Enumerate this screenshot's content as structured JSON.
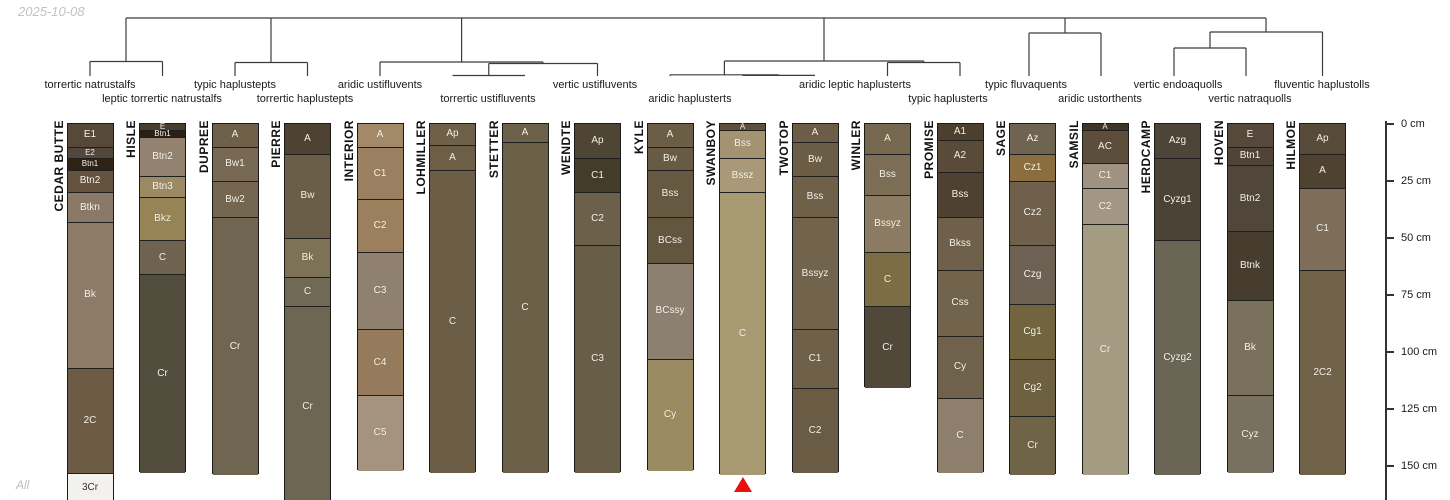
{
  "meta": {
    "timestamp": "2025-10-08",
    "corner_label": "All"
  },
  "chart_data": {
    "type": "soil-profile-dendrogram",
    "title": "",
    "depth_axis": {
      "unit": "cm",
      "ticks": [
        {
          "cm": 0,
          "label": "0 cm"
        },
        {
          "cm": 25,
          "label": "25 cm"
        },
        {
          "cm": 50,
          "label": "50 cm"
        },
        {
          "cm": 75,
          "label": "75 cm"
        },
        {
          "cm": 100,
          "label": "100 cm"
        },
        {
          "cm": 125,
          "label": "125 cm"
        },
        {
          "cm": 150,
          "label": "150 cm"
        }
      ]
    },
    "line_color": "#3c3c3c",
    "dendrogram_segments": [
      [
        126,
        18,
        1266,
        18
      ],
      [
        126,
        18,
        126,
        61.5
      ],
      [
        90,
        61.5,
        162.5,
        61.5
      ],
      [
        90,
        61.5,
        90,
        76
      ],
      [
        162.5,
        61.5,
        162.5,
        76
      ],
      [
        271,
        18,
        271,
        62.5
      ],
      [
        235,
        62.5,
        307.5,
        62.5
      ],
      [
        235,
        62.5,
        235,
        76
      ],
      [
        307.5,
        62.5,
        307.5,
        76
      ],
      [
        461.6,
        18,
        461.6,
        62
      ],
      [
        380,
        62,
        543,
        62
      ],
      [
        380,
        62,
        380,
        76
      ],
      [
        543,
        62,
        543,
        63.5
      ],
      [
        488.75,
        63.5,
        597.5,
        63.5
      ],
      [
        597.5,
        63.5,
        597.5,
        76
      ],
      [
        488.75,
        63.5,
        488.75,
        75.5
      ],
      [
        452.5,
        75.5,
        525,
        75.5
      ],
      [
        824,
        18,
        824,
        61
      ],
      [
        724.4,
        61,
        923.75,
        61
      ],
      [
        724.4,
        61,
        724.4,
        74.8
      ],
      [
        670,
        74.8,
        778.75,
        74.8
      ],
      [
        670,
        74.8,
        670,
        76
      ],
      [
        778.75,
        74.8,
        778.75,
        75.4
      ],
      [
        742.5,
        75.4,
        815,
        75.4
      ],
      [
        923.75,
        61,
        923.75,
        62.5
      ],
      [
        887.5,
        62.5,
        960,
        62.5
      ],
      [
        887.5,
        62.5,
        887.5,
        76
      ],
      [
        960,
        62.5,
        960,
        76
      ],
      [
        1065,
        18,
        1065,
        33
      ],
      [
        1029,
        33,
        1101,
        33
      ],
      [
        1029,
        33,
        1029,
        76
      ],
      [
        1101,
        33,
        1101,
        76
      ],
      [
        1266,
        18,
        1266,
        32
      ],
      [
        1210,
        32,
        1322.5,
        32
      ],
      [
        1322.5,
        32,
        1322.5,
        76
      ],
      [
        1210,
        32,
        1210,
        48
      ],
      [
        1174,
        48,
        1246,
        48
      ],
      [
        1174,
        48,
        1174,
        76
      ],
      [
        1246,
        48,
        1246,
        76
      ]
    ],
    "taxa_labels": [
      {
        "text": "torrertic natrustalfs",
        "x": 90,
        "row": 1
      },
      {
        "text": "leptic torrertic natrustalfs",
        "x": 162,
        "row": 2
      },
      {
        "text": "typic haplustepts",
        "x": 235,
        "row": 1
      },
      {
        "text": "torrertic haplustepts",
        "x": 305,
        "row": 2
      },
      {
        "text": "aridic ustifluvents",
        "x": 380,
        "row": 1
      },
      {
        "text": "torrertic ustifluvents",
        "x": 488,
        "row": 2
      },
      {
        "text": "vertic ustifluvents",
        "x": 595,
        "row": 1
      },
      {
        "text": "aridic haplusterts",
        "x": 690,
        "row": 2
      },
      {
        "text": "aridic leptic haplusterts",
        "x": 855,
        "row": 1
      },
      {
        "text": "typic haplusterts",
        "x": 948,
        "row": 2
      },
      {
        "text": "typic fluvaquents",
        "x": 1026,
        "row": 1
      },
      {
        "text": "aridic ustorthents",
        "x": 1100,
        "row": 2
      },
      {
        "text": "vertic endoaquolls",
        "x": 1178,
        "row": 1
      },
      {
        "text": "vertic natraquolls",
        "x": 1250,
        "row": 2
      },
      {
        "text": "fluventic haplustolls",
        "x": 1322,
        "row": 1
      }
    ],
    "profiles": [
      {
        "name": "CEDAR BUTTE",
        "x": 90,
        "horizons": [
          {
            "label": "E1",
            "top": 0,
            "bottom": 10,
            "color": "#57493a"
          },
          {
            "label": "E2",
            "top": 10,
            "bottom": 15,
            "color": "#53463a"
          },
          {
            "label": "Btn1",
            "top": 15,
            "bottom": 20,
            "color": "#2f2316"
          },
          {
            "label": "Btn2",
            "top": 20,
            "bottom": 30,
            "color": "#65523f"
          },
          {
            "label": "Btkn",
            "top": 30,
            "bottom": 43,
            "color": "#8b7968"
          },
          {
            "label": "Bk",
            "top": 43,
            "bottom": 107,
            "color": "#8d7b67"
          },
          {
            "label": "2C",
            "top": 107,
            "bottom": 153,
            "color": "#6e5b46"
          },
          {
            "label": "3Cr",
            "top": 153,
            "bottom": 166,
            "color": "#f2f1ee",
            "text": "#333333"
          }
        ]
      },
      {
        "name": "HISLE",
        "x": 162.5,
        "horizons": [
          {
            "label": "E",
            "top": 0,
            "bottom": 2.5,
            "color": "#4a3e2f"
          },
          {
            "label": "Btn1",
            "top": 2.5,
            "bottom": 5.5,
            "color": "#2b2015"
          },
          {
            "label": "Btn2",
            "top": 5.5,
            "bottom": 23,
            "color": "#93826f"
          },
          {
            "label": "Btn3",
            "top": 23,
            "bottom": 32,
            "color": "#9b8a64"
          },
          {
            "label": "Bkz",
            "top": 32,
            "bottom": 51,
            "color": "#968356"
          },
          {
            "label": "C",
            "top": 51,
            "bottom": 66,
            "color": "#6f6350"
          },
          {
            "label": "Cr",
            "top": 66,
            "bottom": 153,
            "color": "#524d3d"
          }
        ]
      },
      {
        "name": "DUPREE",
        "x": 235,
        "horizons": [
          {
            "label": "A",
            "top": 0,
            "bottom": 10,
            "color": "#6f6149"
          },
          {
            "label": "Bw1",
            "top": 10,
            "bottom": 25,
            "color": "#776954"
          },
          {
            "label": "Bw2",
            "top": 25,
            "bottom": 41,
            "color": "#74664f"
          },
          {
            "label": "Cr",
            "top": 41,
            "bottom": 154,
            "color": "#6f6551"
          }
        ]
      },
      {
        "name": "PIERRE",
        "x": 307.5,
        "horizons": [
          {
            "label": "A",
            "top": 0,
            "bottom": 13,
            "color": "#4e4333"
          },
          {
            "label": "Bw",
            "top": 13,
            "bottom": 50,
            "color": "#6b5e49"
          },
          {
            "label": "Bk",
            "top": 50,
            "bottom": 67,
            "color": "#7d7156"
          },
          {
            "label": "C",
            "top": 67,
            "bottom": 80,
            "color": "#706955"
          },
          {
            "label": "Cr",
            "top": 80,
            "bottom": 168,
            "color": "#6c6652"
          }
        ]
      },
      {
        "name": "INTERIOR",
        "x": 380,
        "horizons": [
          {
            "label": "A",
            "top": 0,
            "bottom": 10,
            "color": "#a28a68"
          },
          {
            "label": "C1",
            "top": 10,
            "bottom": 33,
            "color": "#9a8061"
          },
          {
            "label": "C2",
            "top": 33,
            "bottom": 56,
            "color": "#9c7f5d"
          },
          {
            "label": "C3",
            "top": 56,
            "bottom": 90,
            "color": "#90806f"
          },
          {
            "label": "C4",
            "top": 90,
            "bottom": 119,
            "color": "#957a5b"
          },
          {
            "label": "C5",
            "top": 119,
            "bottom": 152,
            "color": "#a6937f"
          }
        ]
      },
      {
        "name": "LOHMILLER",
        "x": 452.5,
        "horizons": [
          {
            "label": "Ap",
            "top": 0,
            "bottom": 9,
            "color": "#6e6049"
          },
          {
            "label": "A",
            "top": 9,
            "bottom": 20,
            "color": "#6c5e47"
          },
          {
            "label": "C",
            "top": 20,
            "bottom": 153,
            "color": "#6b5d46"
          }
        ]
      },
      {
        "name": "STETTER",
        "x": 525,
        "horizons": [
          {
            "label": "A",
            "top": 0,
            "bottom": 8,
            "color": "#6e6149"
          },
          {
            "label": "C",
            "top": 8,
            "bottom": 153,
            "color": "#6c5f48"
          }
        ]
      },
      {
        "name": "WENDTE",
        "x": 597.5,
        "horizons": [
          {
            "label": "Ap",
            "top": 0,
            "bottom": 15,
            "color": "#4f4534"
          },
          {
            "label": "C1",
            "top": 15,
            "bottom": 30,
            "color": "#443c2a"
          },
          {
            "label": "C2",
            "top": 30,
            "bottom": 53,
            "color": "#6d604b"
          },
          {
            "label": "C3",
            "top": 53,
            "bottom": 153,
            "color": "#685d47"
          }
        ]
      },
      {
        "name": "KYLE",
        "x": 670,
        "horizons": [
          {
            "label": "A",
            "top": 0,
            "bottom": 10,
            "color": "#6b5d46"
          },
          {
            "label": "Bw",
            "top": 10,
            "bottom": 20,
            "color": "#685b44"
          },
          {
            "label": "Bss",
            "top": 20,
            "bottom": 41,
            "color": "#665841"
          },
          {
            "label": "BCss",
            "top": 41,
            "bottom": 61,
            "color": "#62563f"
          },
          {
            "label": "BCssy",
            "top": 61,
            "bottom": 103,
            "color": "#8c8171"
          },
          {
            "label": "Cy",
            "top": 103,
            "bottom": 152,
            "color": "#9b8b63"
          }
        ]
      },
      {
        "name": "SWANBOY",
        "x": 742.5,
        "horizons": [
          {
            "label": "A",
            "top": 0,
            "bottom": 2.5,
            "color": "#5f5139"
          },
          {
            "label": "Bss",
            "top": 2.5,
            "bottom": 15,
            "color": "#a39373"
          },
          {
            "label": "Bssz",
            "top": 15,
            "bottom": 30,
            "color": "#a99979"
          },
          {
            "label": "C",
            "top": 30,
            "bottom": 154,
            "color": "#a89a73"
          }
        ]
      },
      {
        "name": "TWOTOP",
        "x": 815,
        "horizons": [
          {
            "label": "A",
            "top": 0,
            "bottom": 8,
            "color": "#6b5d46"
          },
          {
            "label": "Bw",
            "top": 8,
            "bottom": 23,
            "color": "#6a5c45"
          },
          {
            "label": "Bss",
            "top": 23,
            "bottom": 41,
            "color": "#6e6049"
          },
          {
            "label": "Bssyz",
            "top": 41,
            "bottom": 90,
            "color": "#71634c"
          },
          {
            "label": "C1",
            "top": 90,
            "bottom": 116,
            "color": "#6e6049"
          },
          {
            "label": "C2",
            "top": 116,
            "bottom": 153,
            "color": "#695b44"
          }
        ]
      },
      {
        "name": "WINLER",
        "x": 887.5,
        "horizons": [
          {
            "label": "A",
            "top": 0,
            "bottom": 13,
            "color": "#76674f"
          },
          {
            "label": "Bss",
            "top": 13,
            "bottom": 31,
            "color": "#7c6d55"
          },
          {
            "label": "Bssyz",
            "top": 31,
            "bottom": 56,
            "color": "#8b7b62"
          },
          {
            "label": "C",
            "top": 56,
            "bottom": 80,
            "color": "#7e6c45"
          },
          {
            "label": "Cr",
            "top": 80,
            "bottom": 116,
            "color": "#50493a"
          }
        ]
      },
      {
        "name": "PROMISE",
        "x": 960,
        "horizons": [
          {
            "label": "A1",
            "top": 0,
            "bottom": 7,
            "color": "#4d3f2d"
          },
          {
            "label": "A2",
            "top": 7,
            "bottom": 21,
            "color": "#594b37"
          },
          {
            "label": "Bss",
            "top": 21,
            "bottom": 41,
            "color": "#4f4131"
          },
          {
            "label": "Bkss",
            "top": 41,
            "bottom": 64,
            "color": "#6e604b"
          },
          {
            "label": "Css",
            "top": 64,
            "bottom": 93,
            "color": "#71634c"
          },
          {
            "label": "Cy",
            "top": 93,
            "bottom": 120,
            "color": "#6f614b"
          },
          {
            "label": "C",
            "top": 120,
            "bottom": 153,
            "color": "#8e7f6c"
          }
        ]
      },
      {
        "name": "SAGE",
        "x": 1032.5,
        "horizons": [
          {
            "label": "Az",
            "top": 0,
            "bottom": 13,
            "color": "#6f6352"
          },
          {
            "label": "Cz1",
            "top": 13,
            "bottom": 25,
            "color": "#8b6e3f"
          },
          {
            "label": "Cz2",
            "top": 25,
            "bottom": 53,
            "color": "#6e604b"
          },
          {
            "label": "Czg",
            "top": 53,
            "bottom": 79,
            "color": "#6c6153"
          },
          {
            "label": "Cg1",
            "top": 79,
            "bottom": 103,
            "color": "#71643f"
          },
          {
            "label": "Cg2",
            "top": 103,
            "bottom": 128,
            "color": "#6e6141"
          },
          {
            "label": "Cr",
            "top": 128,
            "bottom": 154,
            "color": "#6f6447"
          }
        ]
      },
      {
        "name": "SAMSIL",
        "x": 1105,
        "horizons": [
          {
            "label": "A",
            "top": 0,
            "bottom": 2.5,
            "color": "#403627"
          },
          {
            "label": "AC",
            "top": 2.5,
            "bottom": 17,
            "color": "#5c4e3b"
          },
          {
            "label": "C1",
            "top": 17,
            "bottom": 28,
            "color": "#a09281"
          },
          {
            "label": "C2",
            "top": 28,
            "bottom": 44,
            "color": "#a49685"
          },
          {
            "label": "Cr",
            "top": 44,
            "bottom": 154,
            "color": "#a49b83"
          }
        ]
      },
      {
        "name": "HERDCAMP",
        "x": 1177.5,
        "horizons": [
          {
            "label": "Azg",
            "top": 0,
            "bottom": 15,
            "color": "#4c4538"
          },
          {
            "label": "Cyzg1",
            "top": 15,
            "bottom": 51,
            "color": "#4a4336"
          },
          {
            "label": "Cyzg2",
            "top": 51,
            "bottom": 154,
            "color": "#6b6556"
          }
        ]
      },
      {
        "name": "HOVEN",
        "x": 1250,
        "horizons": [
          {
            "label": "E",
            "top": 0,
            "bottom": 10,
            "color": "#56493b"
          },
          {
            "label": "Btn1",
            "top": 10,
            "bottom": 18,
            "color": "#4f4437"
          },
          {
            "label": "Btn2",
            "top": 18,
            "bottom": 47,
            "color": "#50473a"
          },
          {
            "label": "Btnk",
            "top": 47,
            "bottom": 77,
            "color": "#463d2e"
          },
          {
            "label": "Bk",
            "top": 77,
            "bottom": 119,
            "color": "#7a715d"
          },
          {
            "label": "Cyz",
            "top": 119,
            "bottom": 153,
            "color": "#78715f"
          }
        ]
      },
      {
        "name": "HILMOE",
        "x": 1322.5,
        "horizons": [
          {
            "label": "Ap",
            "top": 0,
            "bottom": 13,
            "color": "#594b39"
          },
          {
            "label": "A",
            "top": 13,
            "bottom": 28,
            "color": "#504231"
          },
          {
            "label": "C1",
            "top": 28,
            "bottom": 64,
            "color": "#7d6d59"
          },
          {
            "label": "2C2",
            "top": 64,
            "bottom": 154,
            "color": "#6f6249"
          }
        ]
      }
    ],
    "marker": {
      "shape": "triangle-up",
      "profile": "SWANBOY",
      "x": 742.5,
      "color": "#ea1010"
    }
  }
}
